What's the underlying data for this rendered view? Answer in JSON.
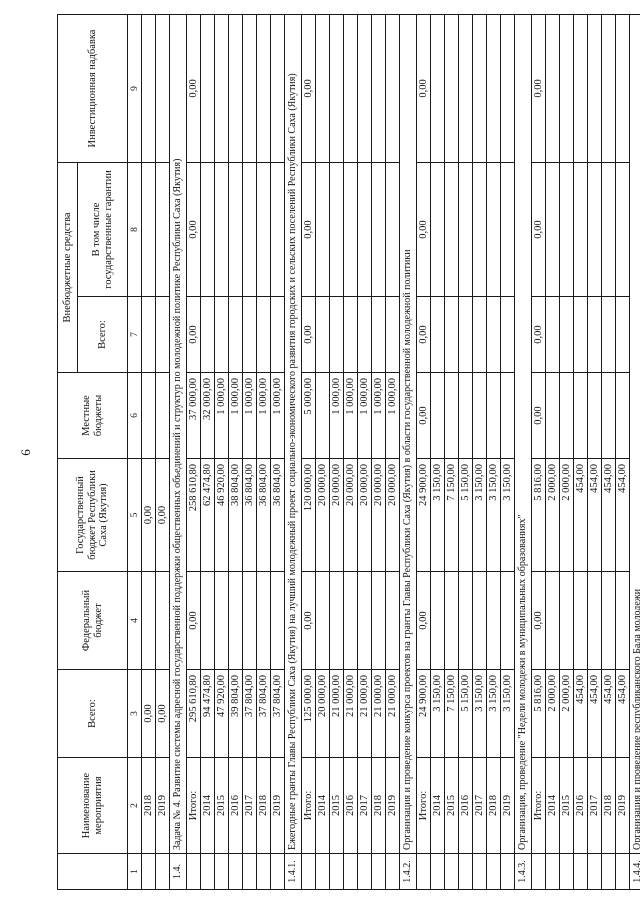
{
  "page": {
    "number": "6"
  },
  "table": {
    "header": {
      "col1": "",
      "col2": "Наименование мероприятия",
      "col3": "Всего:",
      "col4": "Федеральный бюджет",
      "col5": "Государственный бюджет Республики Саха (Якутия)",
      "col6": "Местные бюджеты",
      "group78": "Внебюджетные средства",
      "col7": "Всего:",
      "col8": "В том числе государственные гарантии",
      "col9": "Инвестиционная надбавка",
      "nums": [
        "1",
        "2",
        "3",
        "4",
        "5",
        "6",
        "7",
        "8",
        "9"
      ]
    },
    "pre_rows": [
      [
        "2018",
        "0,00",
        "",
        "0,00",
        "",
        "",
        "",
        ""
      ],
      [
        "2019",
        "0,00",
        "",
        "0,00",
        "",
        "",
        "",
        ""
      ]
    ],
    "sections": [
      {
        "num": "1.4.",
        "title": "Задача № 4. Развитие системы адресной государственной поддержки  общественных объединений и структур по молодежной политике Республики Саха (Якутия)",
        "rows": [
          [
            "Итого:",
            "295 610,80",
            "0,00",
            "258 610,80",
            "37 000,00",
            "0,00",
            "0,00",
            "0,00"
          ],
          [
            "2014",
            "94 474,80",
            "",
            "62 474,80",
            "32 000,00",
            "",
            "",
            ""
          ],
          [
            "2015",
            "47 920,00",
            "",
            "46 920,00",
            "1 000,00",
            "",
            "",
            ""
          ],
          [
            "2016",
            "39 804,00",
            "",
            "38 804,00",
            "1 000,00",
            "",
            "",
            ""
          ],
          [
            "2017",
            "37 804,00",
            "",
            "36 804,00",
            "1 000,00",
            "",
            "",
            ""
          ],
          [
            "2018",
            "37 804,00",
            "",
            "36 804,00",
            "1 000,00",
            "",
            "",
            ""
          ],
          [
            "2019",
            "37 804,00",
            "",
            "36 804,00",
            "1 000,00",
            "",
            "",
            ""
          ]
        ]
      },
      {
        "num": "1.4.1.",
        "title": "Ежегодные гранты Главы Республики Саха (Якутия) на лучший молодежный проект социально-экономического развития городских и сельских поселений Республики Саха (Якутия)",
        "rows": [
          [
            "Итого:",
            "125 000,00",
            "0,00",
            "120 000,00",
            "5 000,00",
            "0,00",
            "0,00",
            "0,00"
          ],
          [
            "2014",
            "20 000,00",
            "",
            "20 000,00",
            "",
            "",
            "",
            ""
          ],
          [
            "2015",
            "21 000,00",
            "",
            "20 000,00",
            "1 000,00",
            "",
            "",
            ""
          ],
          [
            "2016",
            "21 000,00",
            "",
            "20 000,00",
            "1 000,00",
            "",
            "",
            ""
          ],
          [
            "2017",
            "21 000,00",
            "",
            "20 000,00",
            "1 000,00",
            "",
            "",
            ""
          ],
          [
            "2018",
            "21 000,00",
            "",
            "20 000,00",
            "1 000,00",
            "",
            "",
            ""
          ],
          [
            "2019",
            "21 000,00",
            "",
            "20 000,00",
            "1 000,00",
            "",
            "",
            ""
          ]
        ]
      },
      {
        "num": "1.4.2.",
        "title": "Организация и проведение конкурса проектов на гранты Главы Республики Саха (Якутия) в области государственной молодежной политики",
        "rows": [
          [
            "Итого:",
            "24 900,00",
            "0,00",
            "24 900,00",
            "0,00",
            "0,00",
            "0,00",
            "0,00"
          ],
          [
            "2014",
            "3 150,00",
            "",
            "3 150,00",
            "",
            "",
            "",
            ""
          ],
          [
            "2015",
            "7 150,00",
            "",
            "7 150,00",
            "",
            "",
            "",
            ""
          ],
          [
            "2016",
            "5 150,00",
            "",
            "5 150,00",
            "",
            "",
            "",
            ""
          ],
          [
            "2017",
            "3 150,00",
            "",
            "3 150,00",
            "",
            "",
            "",
            ""
          ],
          [
            "2018",
            "3 150,00",
            "",
            "3 150,00",
            "",
            "",
            "",
            ""
          ],
          [
            "2019",
            "3 150,00",
            "",
            "3 150,00",
            "",
            "",
            "",
            ""
          ]
        ]
      },
      {
        "num": "1.4.3.",
        "title": "Организация, проведение \"Недели молодежи в муниципальных образованиях\"",
        "rows": [
          [
            "Итого:",
            "5 816,00",
            "0,00",
            "5 816,00",
            "0,00",
            "0,00",
            "0,00",
            "0,00"
          ],
          [
            "2014",
            "2 000,00",
            "",
            "2 000,00",
            "",
            "",
            "",
            ""
          ],
          [
            "2015",
            "2 000,00",
            "",
            "2 000,00",
            "",
            "",
            "",
            ""
          ],
          [
            "2016",
            "454,00",
            "",
            "454,00",
            "",
            "",
            "",
            ""
          ],
          [
            "2017",
            "454,00",
            "",
            "454,00",
            "",
            "",
            "",
            ""
          ],
          [
            "2018",
            "454,00",
            "",
            "454,00",
            "",
            "",
            "",
            ""
          ],
          [
            "2019",
            "454,00",
            "",
            "454,00",
            "",
            "",
            "",
            ""
          ]
        ]
      },
      {
        "num": "1.4.4.",
        "title": "Организация и проведение республиканского Бала молодежи",
        "rows": [
          [
            "Итого:",
            "10 600,00",
            "0,00",
            "10 600,00",
            "0,00",
            "0,00",
            "0,00",
            "0,00"
          ]
        ]
      }
    ]
  }
}
